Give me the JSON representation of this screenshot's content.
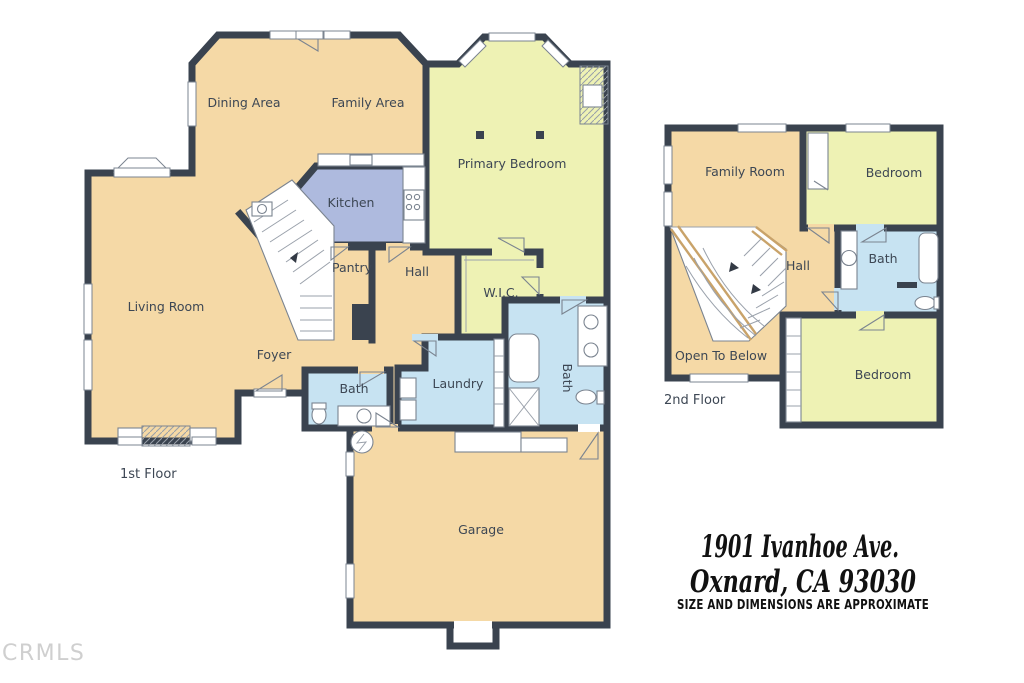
{
  "palette": {
    "wall": "#3a434f",
    "room_tan": "#f5d9a6",
    "room_yellow": "#eef2b4",
    "kitchen_blue": "#aebade",
    "bath_blue": "#c7e3f2",
    "stair_rail": "#c9a36a",
    "label_text": "#3d4754",
    "text_dark": "#111111",
    "watermark_color": "#cfcfcf",
    "background": "#ffffff"
  },
  "watermark": "CRMLS",
  "address": {
    "line1": "1901 Ivanhoe Ave.",
    "line2": "Oxnard, CA 93030",
    "disclaimer": "SIZE AND DIMENSIONS ARE APPROXIMATE"
  },
  "floor1": {
    "label": "1st Floor",
    "rooms": {
      "dining": "Dining Area",
      "family": "Family Area",
      "kitchen": "Kitchen",
      "primary_bedroom": "Primary Bedroom",
      "living": "Living Room",
      "pantry": "Pantry",
      "hall": "Hall",
      "wic": "W.I.C.",
      "foyer": "Foyer",
      "bath": "Bath",
      "laundry": "Laundry",
      "bath2": "Bath",
      "garage": "Garage"
    }
  },
  "floor2": {
    "label": "2nd Floor",
    "rooms": {
      "family_room": "Family Room",
      "bedroom1": "Bedroom",
      "hall": "Hall",
      "bath": "Bath",
      "open_to_below": "Open To Below",
      "bedroom2": "Bedroom"
    }
  }
}
